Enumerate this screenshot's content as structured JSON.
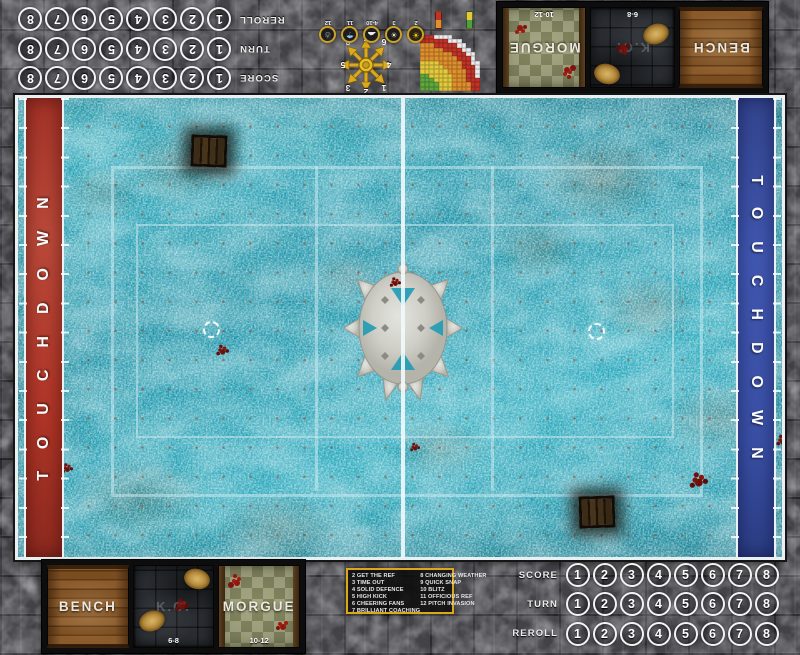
{
  "board": {
    "stone_color": "#434347",
    "accent_gold": "#dda71b"
  },
  "pitch": {
    "touchdown_text": "TOUCHDOWN",
    "end_zone_left_color": "#b2392e",
    "end_zone_right_color": "#3d55ab",
    "ice_color": "#219fb6",
    "line_color": "#d2ecf1"
  },
  "trackers": {
    "rows": [
      {
        "label": "SCORE",
        "numbers": [
          "1",
          "2",
          "3",
          "4",
          "5",
          "6",
          "7",
          "8"
        ]
      },
      {
        "label": "TURN",
        "numbers": [
          "1",
          "2",
          "3",
          "4",
          "5",
          "6",
          "7",
          "8"
        ]
      },
      {
        "label": "REROLL",
        "numbers": [
          "1",
          "2",
          "3",
          "4",
          "5",
          "6",
          "7",
          "8"
        ]
      }
    ]
  },
  "dugout": {
    "bench_label": "BENCH",
    "ko_label": "K.O.",
    "ko_range": "6-8",
    "morgue_label": "MORGUE",
    "morgue_range": "10-12"
  },
  "weather": {
    "entries": [
      {
        "value": "2",
        "icon": "sun-icon"
      },
      {
        "value": "3",
        "icon": "sun-cloud-icon"
      },
      {
        "value": "4-10",
        "icon": "cloud-icon"
      },
      {
        "value": "11",
        "icon": "rain-icon"
      },
      {
        "value": "12",
        "icon": "snow-icon"
      }
    ]
  },
  "scatter_compass": {
    "numbers": [
      "1",
      "2",
      "3",
      "4",
      "5",
      "6",
      "7",
      "8"
    ],
    "arrow_color": "#dba91c"
  },
  "range_ruler": {
    "colors": {
      "G": "#5fa83e",
      "Y": "#e3c93c",
      "O": "#df8f2d",
      "R": "#c13327",
      "W": "#ececec"
    },
    "rows": [
      "RROOOOYYYGGGG",
      "RROOOOYYYGGGG",
      "RRROOOYYYYGGG",
      "WRROOOYYYYYGG",
      "WRROOOOYYYYYY",
      "WRRROOOOYYYYY",
      "WWRROOOOOYYYY",
      ".WRRROOOOOOOO",
      ".WWRRROOOOOOO",
      "..WWRRRROOOOO",
      "...WWRRRRROOO",
      "....WWWRRRRRR",
      "......WWWWRRR"
    ]
  },
  "kickoff_table": {
    "left_column": [
      "2 GET THE REF",
      "3 TIME OUT",
      "4 SOLID DEFENCE",
      "5 HIGH KICK",
      "6 CHEERING FANS",
      "7 BRILLIANT COACHING"
    ],
    "right_column": [
      "8 CHANGING WEATHER",
      "9 QUICK SNAP",
      "10 BLITZ",
      "11 OFFICIOUS REF",
      "12 PITCH INVASION"
    ]
  }
}
